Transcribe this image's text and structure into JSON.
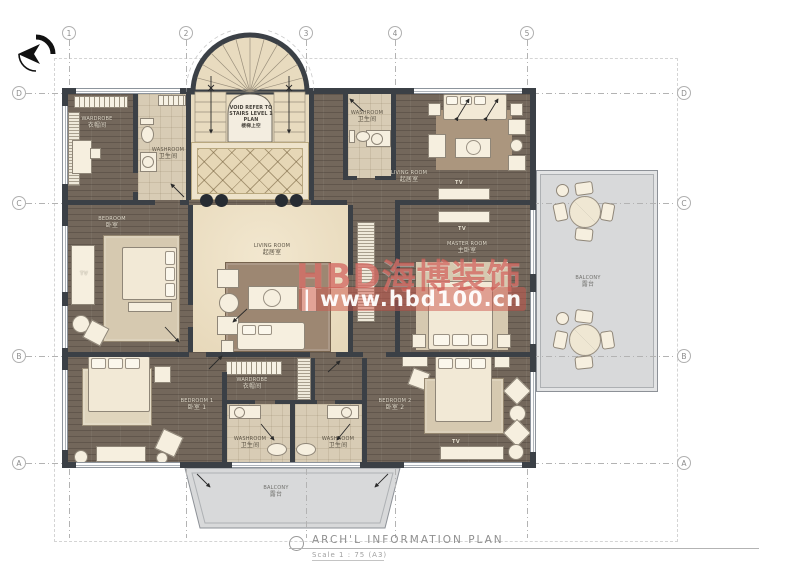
{
  "grid": {
    "columns": [
      "1",
      "2",
      "3",
      "4",
      "5"
    ],
    "rows": [
      "D",
      "C",
      "B",
      "A"
    ]
  },
  "icons": {
    "compass": "compass-north-arrow",
    "title_marker": "detail-circle"
  },
  "stair_note": {
    "line1": "VOID REFER TO",
    "line2": "STAIRS LEVEL 1 PLAN",
    "line3": "楼梯上空"
  },
  "rooms": {
    "wardrobe_top_left": {
      "en": "WARDROBE",
      "cn": "衣帽间"
    },
    "washroom_top_left": {
      "en": "WASHROOM",
      "cn": "卫生间"
    },
    "washroom_top_right": {
      "en": "WASHROOM",
      "cn": "卫生间"
    },
    "living_top_right": {
      "en": "LIVING ROOM",
      "cn": "起居室"
    },
    "living_center": {
      "en": "LIVING ROOM",
      "cn": "起居室"
    },
    "bedroom_left": {
      "en": "BEDROOM",
      "cn": "卧室"
    },
    "master_room": {
      "en": "MASTER ROOM",
      "cn": "主卧室"
    },
    "bedroom_1": {
      "en": "BEDROOM 1",
      "cn": "卧室 1"
    },
    "bedroom_2": {
      "en": "BEDROOM 2",
      "cn": "卧室 2"
    },
    "wardrobe_bottom": {
      "en": "WARDROBE",
      "cn": "衣帽间"
    },
    "washroom_bottom_left": {
      "en": "WASHROOM",
      "cn": "卫生间"
    },
    "washroom_bottom_right": {
      "en": "WASHROOM",
      "cn": "卫生间"
    },
    "balcony_right": {
      "en": "BALCONY",
      "cn": "露台"
    },
    "balcony_bottom": {
      "en": "BALCONY",
      "cn": "露台"
    }
  },
  "tv_labels": {
    "bedroom_left": "TV",
    "living_top_right": "TV",
    "master_room": "TV",
    "bedroom_2": "TV"
  },
  "watermark": {
    "brand": "HBD海博装饰",
    "url": "| www.hbd100.cn"
  },
  "titleblock": {
    "title": "ARCH'L  INFORMATION  PLAN",
    "scale": "Scale  1 : 75  (A3)"
  }
}
